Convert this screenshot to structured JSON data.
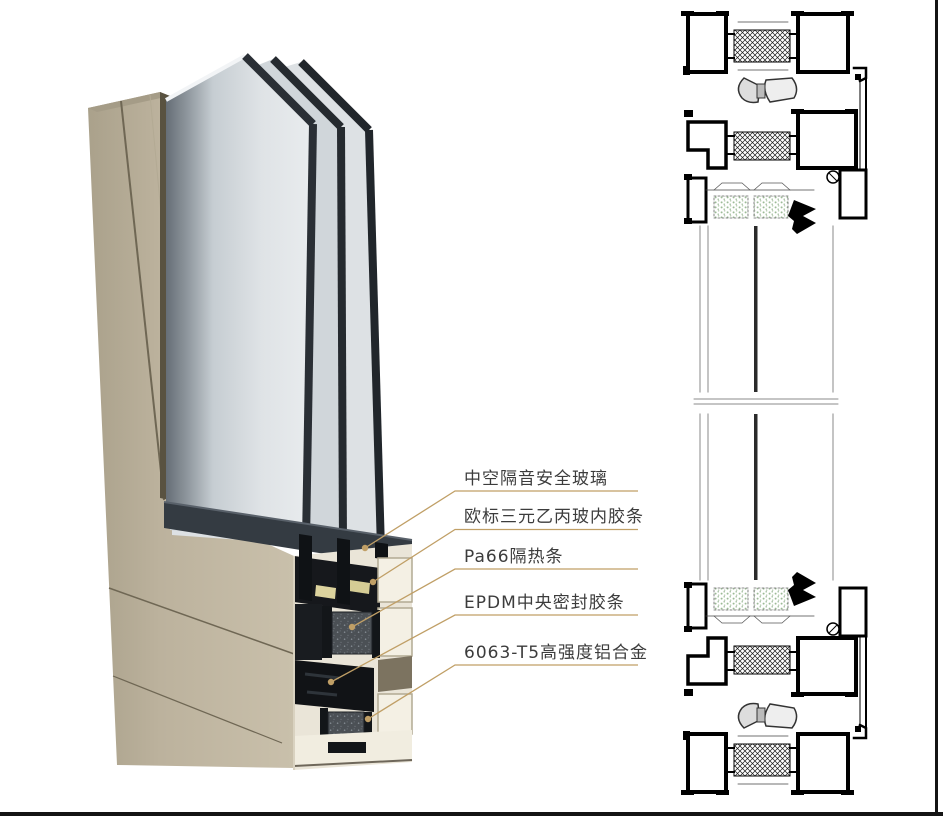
{
  "figure": {
    "callouts": [
      {
        "text": "中空隔音安全玻璃"
      },
      {
        "text": "欧标三元乙丙玻内胶条"
      },
      {
        "text": "Pa66隔热条"
      },
      {
        "text": "EPDM中央密封胶条"
      },
      {
        "text": "6063-T5高强度铝合金"
      }
    ],
    "colors": {
      "accent_gold": "#C09F66",
      "champagne_aluminum": "#BCB29D",
      "glass": "#DFE3E6",
      "glass_edge_dark": "#2A2F35",
      "thermal_break_gray": "#4B5055",
      "sealant_yellow": "#DCD39E",
      "label_text": "#3C3C3C",
      "cad_line": "#000000",
      "cad_spacer_green": "#9DBB97",
      "page_border": "#141414"
    }
  }
}
